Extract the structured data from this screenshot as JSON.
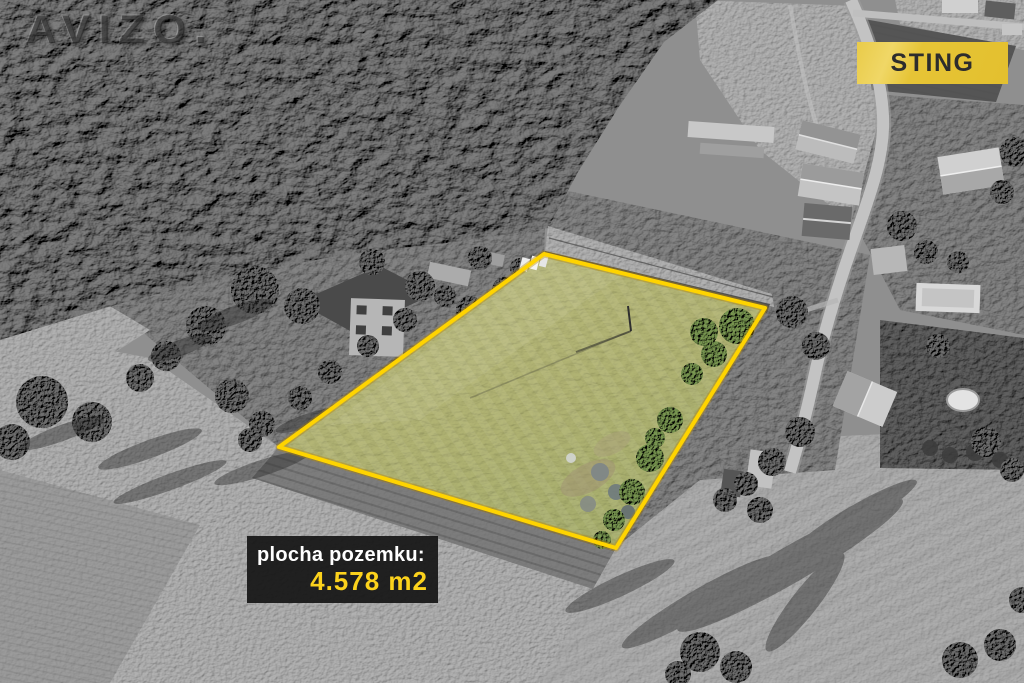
{
  "overlays": {
    "watermark": {
      "text": "AVIZO."
    },
    "agency_badge": {
      "label": "STING",
      "background_color": "#e7c63b",
      "text_color": "#2d2d2d"
    },
    "area_label": {
      "title": "plocha pozemku:",
      "value": "4.578 m2",
      "title_color": "#ffffff",
      "value_color": "#fcd21c",
      "background_color": "#1a1a1a"
    }
  },
  "plot_highlight": {
    "outline_color": "#ffd60a",
    "grass_color": "#a9ab6c"
  }
}
